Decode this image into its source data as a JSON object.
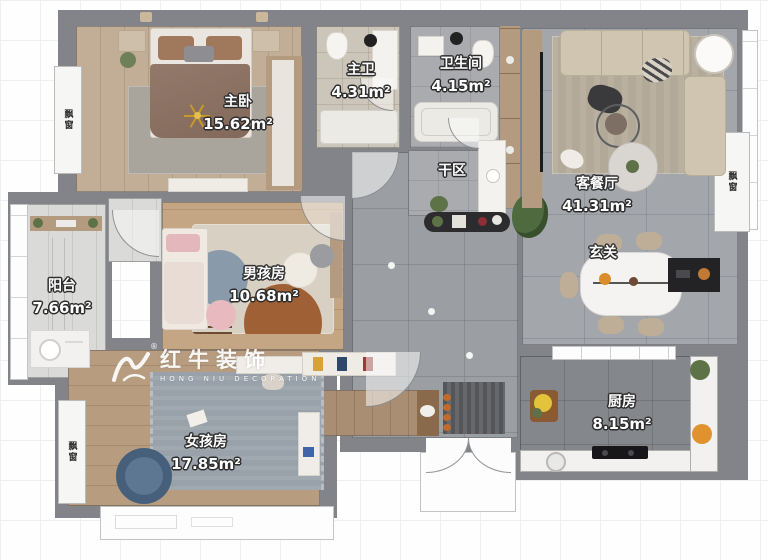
{
  "rooms": [
    {
      "id": "master-bedroom",
      "name": "主卧",
      "area": "15.62m²"
    },
    {
      "id": "master-bath",
      "name": "主卫",
      "area": "4.31m²"
    },
    {
      "id": "bathroom",
      "name": "卫生间",
      "area": "4.15m²"
    },
    {
      "id": "dry-area",
      "name": "干区",
      "area": ""
    },
    {
      "id": "living-dining",
      "name": "客餐厅",
      "area": "41.31m²"
    },
    {
      "id": "foyer",
      "name": "玄关",
      "area": ""
    },
    {
      "id": "balcony",
      "name": "阳台",
      "area": "7.66m²"
    },
    {
      "id": "boy-room",
      "name": "男孩房",
      "area": "10.68m²"
    },
    {
      "id": "girl-room",
      "name": "女孩房",
      "area": "17.85m²"
    },
    {
      "id": "kitchen",
      "name": "厨房",
      "area": "8.15m²"
    }
  ],
  "bay_windows": [
    {
      "label": "飘窗"
    },
    {
      "label": "飘窗"
    },
    {
      "label": "飘窗"
    }
  ],
  "watermark": {
    "brand": "红牛装饰",
    "subtitle": "HONG NIU DECORATION",
    "registered": "®"
  },
  "colors": {
    "wall": "#82848a",
    "tile_corridor": "#9b9ea3",
    "tile_kitchen": "#84878c",
    "wood_master": "#c2ae97",
    "wood_boy": "#c4a584",
    "wood_girl": "#b79c80",
    "rug_living": "#b3a998",
    "sofa": "#cfc5b0",
    "bed_blanket": "#8a7260",
    "rug_girl": "#99a1aa",
    "chair_blue": "#46607c",
    "label_text": "#ffffff",
    "chandelier_gold": "#c49a2a"
  }
}
